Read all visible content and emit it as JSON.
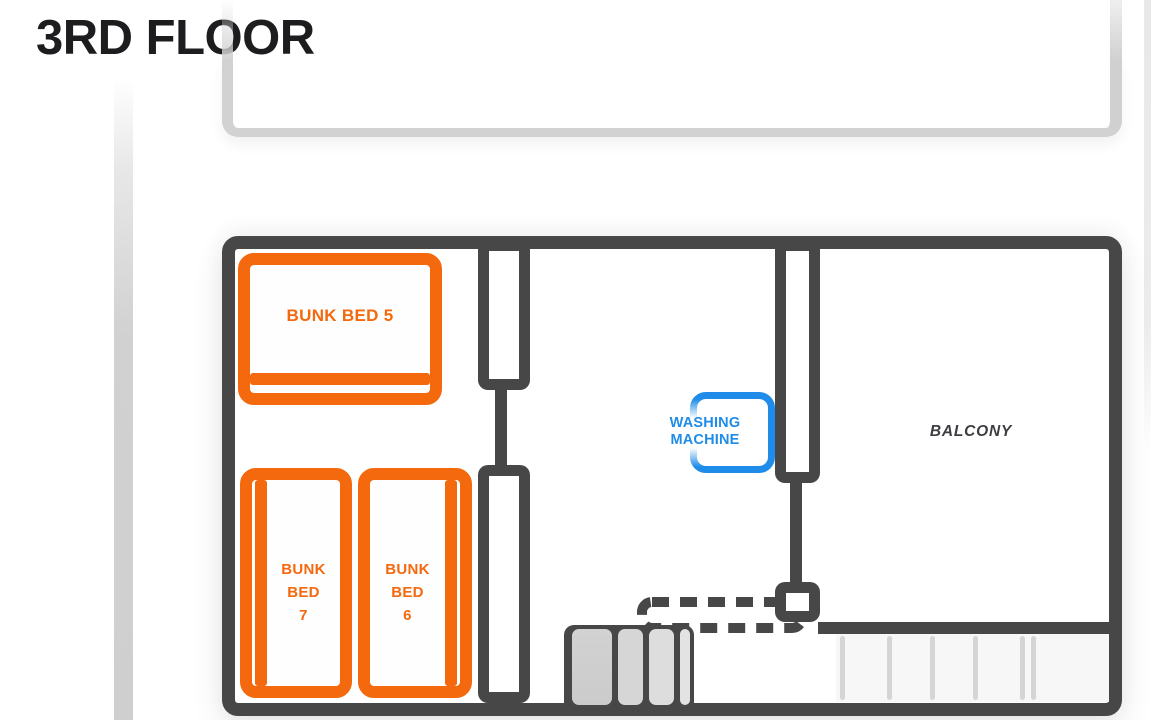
{
  "page": {
    "title": "3RD FLOOR"
  },
  "colors": {
    "wall_dark": "#474747",
    "bed_accent_orange": "#F4680E",
    "appliance_accent_blue": "#1E8CE8",
    "faded_wall_gray": "#D2D2D2",
    "label_dark_gray": "#3D3D42",
    "stair_fill_gray": "#D2D2D2"
  },
  "floor_plan": {
    "rooms": {
      "balcony_label": "BALCONY"
    },
    "beds": {
      "bed5": {
        "label": "BUNK BED 5"
      },
      "bed7": {
        "lines": [
          "BUNK",
          "BED",
          "7"
        ]
      },
      "bed6": {
        "lines": [
          "BUNK",
          "BED",
          "6"
        ]
      }
    },
    "appliances": {
      "washing_machine": {
        "lines": [
          "WASHING",
          "MACHINE"
        ]
      }
    }
  }
}
